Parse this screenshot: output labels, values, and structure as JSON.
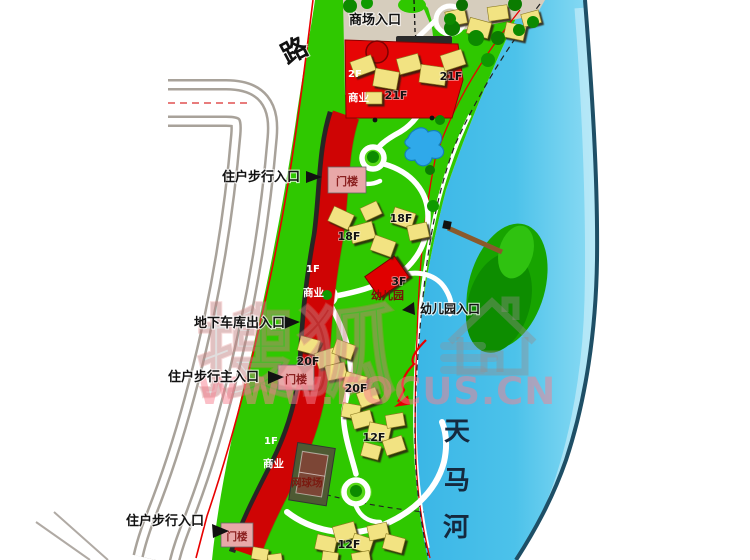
{
  "plan": {
    "labels": {
      "mall_entrance": "商场入口",
      "road": "路",
      "resident_walk_entrance": "住户步行入口",
      "resident_walk_main_entrance": "住户步行主入口",
      "underground_garage": "地下车库出入口",
      "gatehouse": "门楼",
      "kindergarten": "幼儿园",
      "kindergarten_entrance": "幼儿园入口",
      "commercial": "商业",
      "tennis_court": "网球场",
      "river_name": "天马河",
      "river_chars": [
        "天",
        "马",
        "河"
      ],
      "floors": {
        "f1": "1F",
        "f2": "2F",
        "f3": "3F",
        "f12": "12F",
        "f18": "18F",
        "f20": "20F",
        "f21": "21F"
      }
    },
    "watermark": {
      "brand_chars": "搜狐",
      "url": "WWW.FOCUS.CN"
    },
    "icons": {
      "entrance_arrow": "right-pointing solid triangle",
      "house_watermark": "house outline glyph"
    },
    "colors": {
      "grass_green": "#2fc800",
      "tree_green": "#0d8a00",
      "water_blue": "#4cc2ea",
      "river_bank": "#1e4f66",
      "commercial_red": "#e60505",
      "residential_yellow": "#f2e382",
      "gatehouse_pink": "#e8a8a8",
      "boundary_red": "#e80000",
      "plaza_tan": "#d6cdbd",
      "watermark_pink": "#f77f8f"
    }
  }
}
